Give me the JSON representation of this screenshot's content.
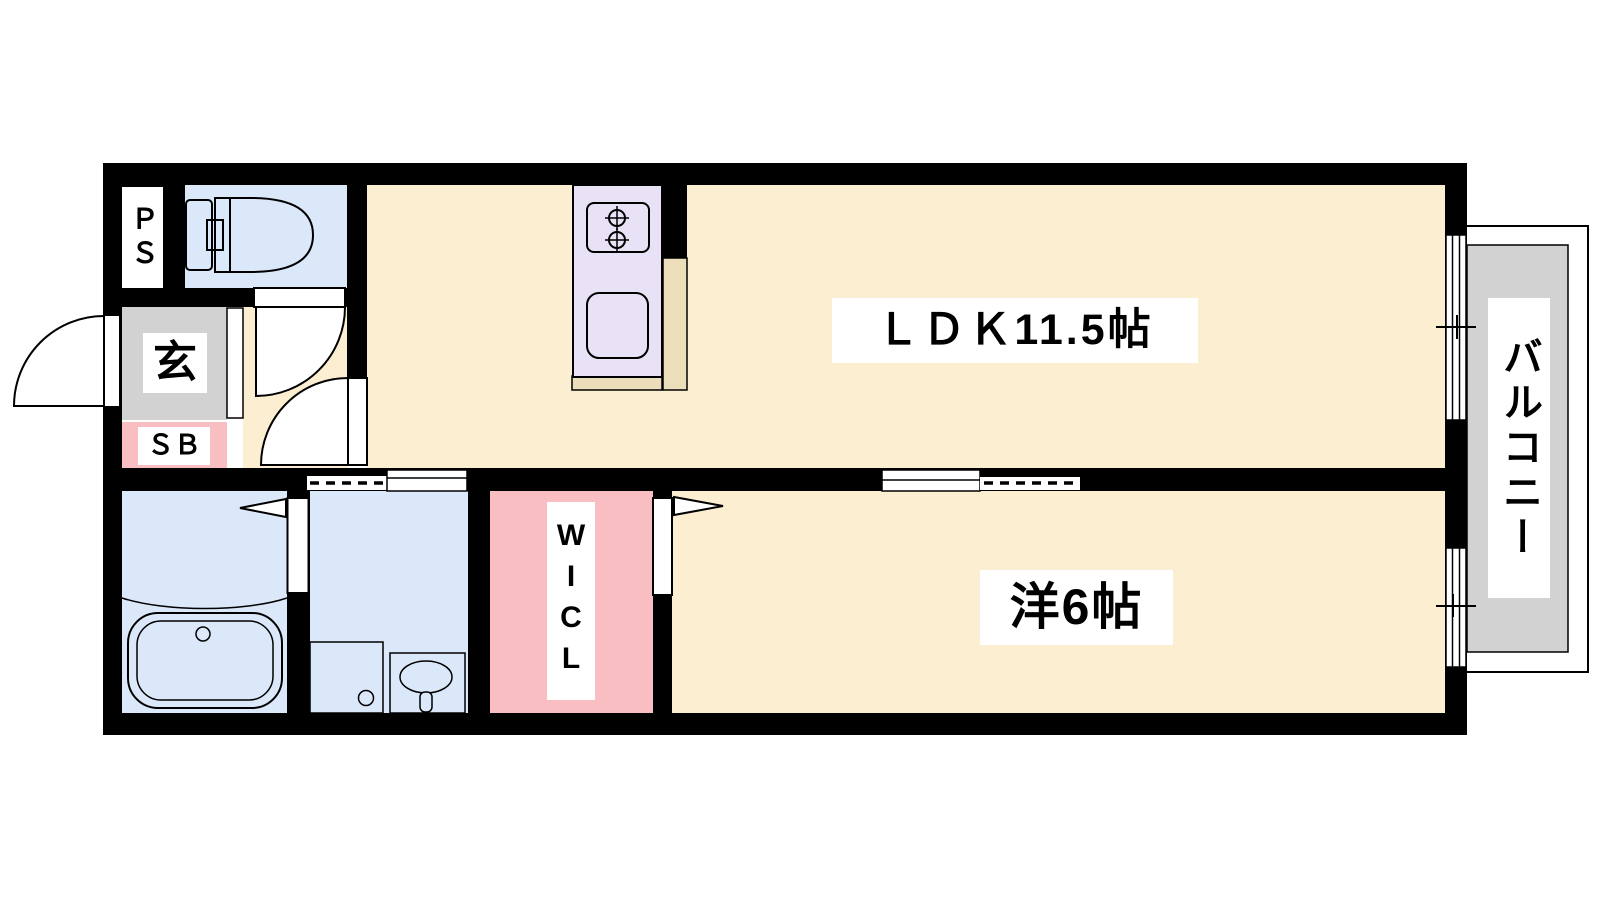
{
  "floor_plan": {
    "rooms": {
      "ldk": {
        "label": "ＬＤＫ11.5帖"
      },
      "western_room": {
        "label": "洋6帖"
      },
      "balcony": {
        "label": "バルコニー"
      },
      "entrance": {
        "label": "玄"
      },
      "shoe_box": {
        "label": "ＳＢ"
      },
      "pipe_space": {
        "label": "ＰＳ"
      },
      "walk_in_closet": {
        "label": "WICL"
      }
    },
    "colors": {
      "wall": "#000000",
      "floor_main": "#fcefd1",
      "floor_wet": "#dbe8fa",
      "floor_pink": "#f8bec1",
      "floor_gray": "#d2d2d2",
      "kitchen_unit": "#e9e2f6",
      "kitchen_counter": "#ecdebb",
      "label_background": "#ffffff",
      "background": "#ffffff"
    }
  }
}
